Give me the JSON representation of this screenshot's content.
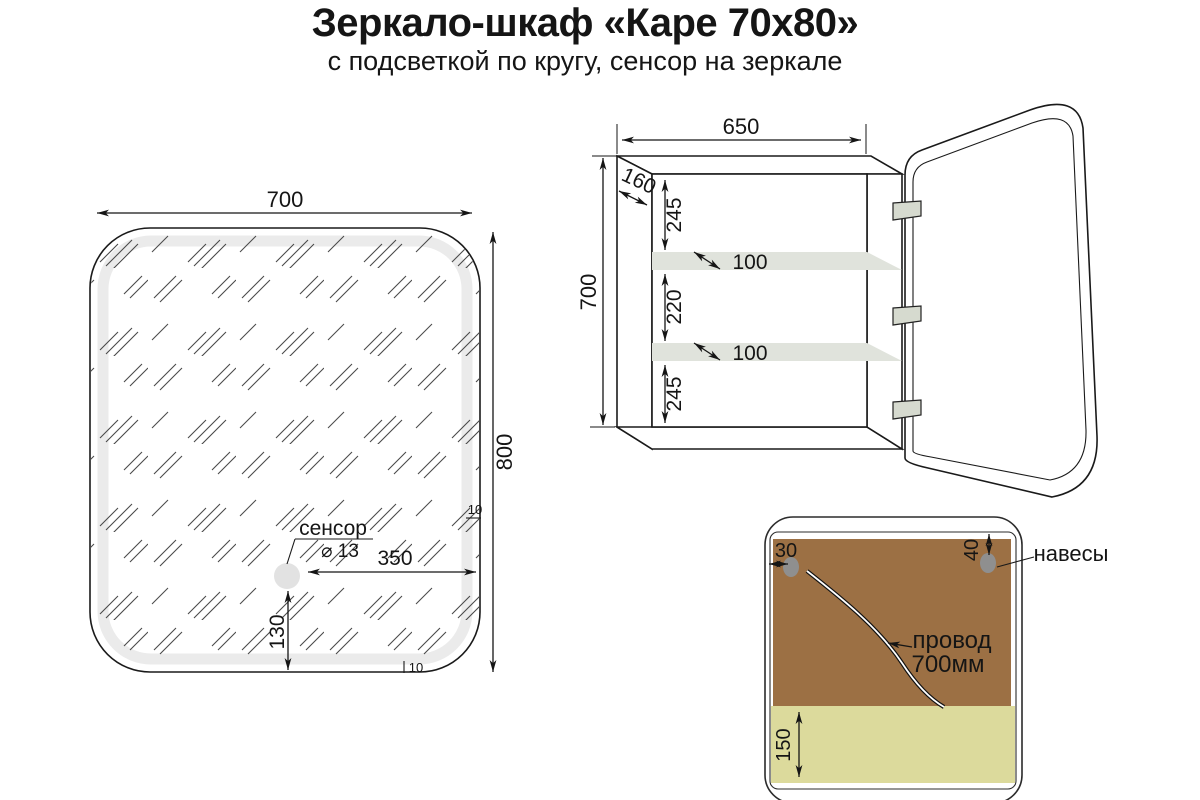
{
  "title": "Зеркало-шкаф «Каре 70х80»",
  "subtitle": "с подсветкой по кругу, сенсор на зеркале",
  "colors": {
    "line": "#1a1a1a",
    "glow_band": "#ebebeb",
    "shelf": "#e0e3dc",
    "hinge": "#d6dacf",
    "hanger": "#8f8f8f",
    "back_panel": "#9c7044",
    "bottom_strip": "#dcda9c",
    "wire_core": "#ffffff"
  },
  "mirror_view": {
    "width": "700",
    "height": "800",
    "sensor_label": "сенсор",
    "sensor_diameter": "⌀ 13",
    "sensor_from_right": "350",
    "sensor_from_bottom": "130",
    "led_band_right": "10",
    "led_band_bottom": "10"
  },
  "cabinet_view": {
    "width": "650",
    "depth": "160",
    "height": "700",
    "top_gap": "245",
    "shelf_depth_top": "100",
    "middle_gap": "220",
    "shelf_depth_bottom": "100",
    "bottom_gap": "245"
  },
  "back_view": {
    "hanger_left_offset": "30",
    "hanger_top_offset": "40",
    "hangers_label": "навесы",
    "wire_line1": "провод",
    "wire_line2": "700мм",
    "strip_height": "150"
  }
}
